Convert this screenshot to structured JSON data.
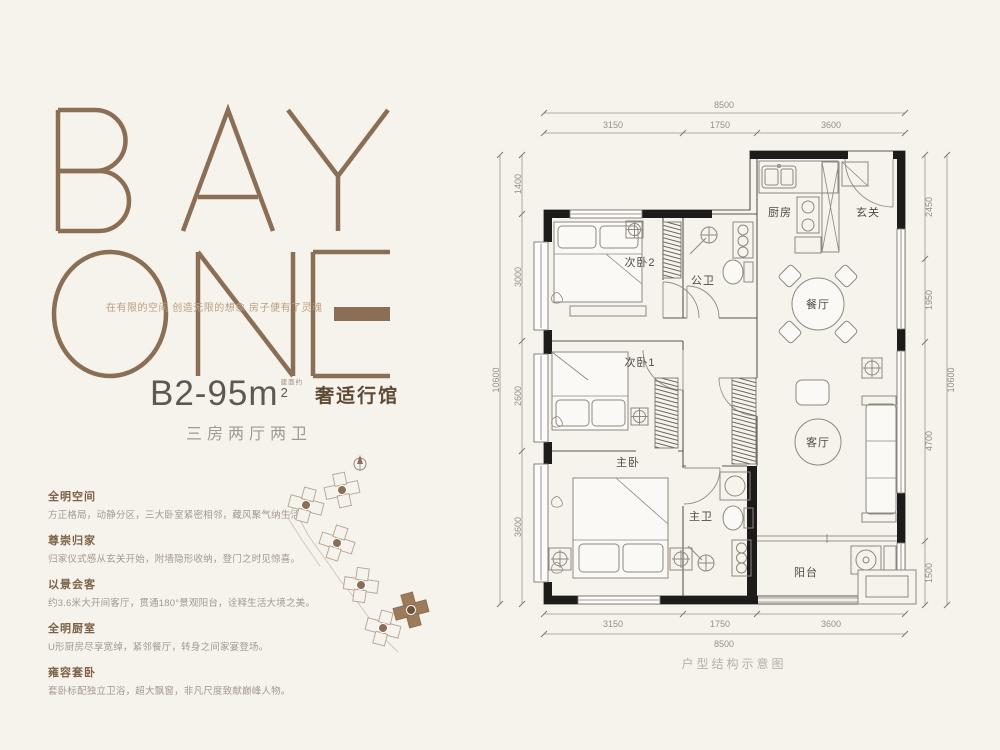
{
  "theme": {
    "bg": "#f6f2ec",
    "brand": "#8a6e55",
    "brand-soft": "#bb9f80",
    "ink": "#5f584e",
    "muted": "#a29a8f",
    "wall": "#1d1c1a",
    "dim": "#95908a",
    "label": "#4f4a44",
    "feature-title": "#7d6247"
  },
  "brand": {
    "word1": "BAY",
    "word2": "ONE",
    "tagline": "在有限的空间 创造无限的想象 房子便有了灵魂"
  },
  "unit": {
    "model": "B2-95m",
    "area_exp": "2",
    "area_prefix": "建面约",
    "title": "奢适行馆",
    "layout": "三房两厅两卫"
  },
  "features": [
    {
      "title": "全明空间",
      "desc": "方正格局，动静分区，三大卧室紧密相邻，藏风聚气纳生活。"
    },
    {
      "title": "尊崇归家",
      "desc": "归家仪式感从玄关开始，附墙隐形收纳，登门之时见惊喜。"
    },
    {
      "title": "以景会客",
      "desc": "约3.6米大开间客厅，贯通180°景观阳台，诠释生活大境之美。"
    },
    {
      "title": "全明厨室",
      "desc": "U形厨房尽享宽绰，紧邻餐厅，转身之间家宴登场。"
    },
    {
      "title": "雍容套卧",
      "desc": "套卧标配独立卫浴，超大飘窗，非凡尺度致献巅峰人物。"
    }
  ],
  "floorplan": {
    "caption": "户型结构示意图",
    "rooms": {
      "kitchen": "厨房",
      "entry": "玄关",
      "bedroom2": "次卧2",
      "guest_bath": "公卫",
      "dining": "餐厅",
      "bedroom1": "次卧1",
      "living": "客厅",
      "master": "主卧",
      "master_bath": "主卫",
      "balcony": "阳台"
    },
    "dims": {
      "top_total": "8500",
      "top_segs": [
        "3150",
        "1750",
        "3600"
      ],
      "bottom_total": "8500",
      "bottom_segs": [
        "3150",
        "1750",
        "3600"
      ],
      "left_total": "10600",
      "left_segs": [
        "1400",
        "3000",
        "2600",
        "3600"
      ],
      "right_total": "10600",
      "right_segs": [
        "2450",
        "1950",
        "4700",
        "1500"
      ]
    }
  }
}
